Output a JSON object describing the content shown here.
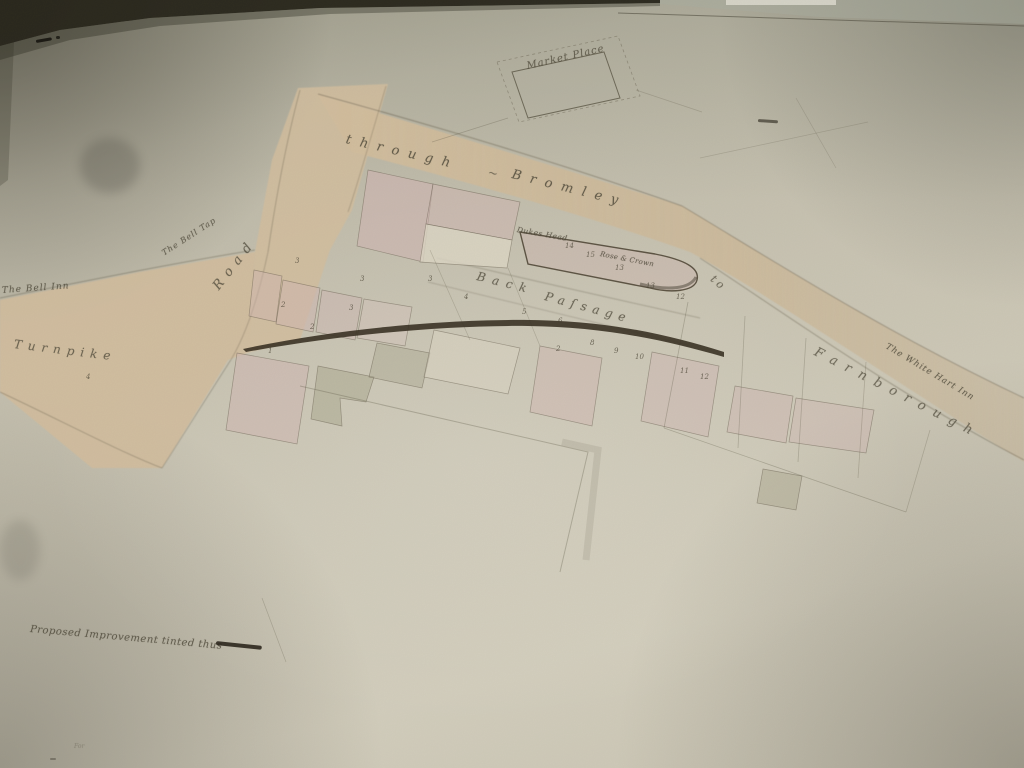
{
  "image_kind": "photograph of a hand-drawn 19th-century town improvement plan",
  "colors": {
    "paper": "#c8c3b2",
    "road_tint": "#d0bc9c",
    "building_pink": "#d0b5b2",
    "building_gray": "#aaa78e",
    "building_cream": "#dcd6c4",
    "ink": "#4c4738",
    "improvement_dark": "#352d20",
    "photo_background": "#262419"
  },
  "legend": {
    "text": "Proposed Improvement tinted thus",
    "swatch": "dark ink line"
  },
  "labels": [
    {
      "name": "market-place-label",
      "text": "Market Place",
      "x": 527,
      "y": 62,
      "rot": -13,
      "size": 10,
      "sp": 1,
      "op": 0.75
    },
    {
      "name": "road-name-through",
      "text": "through",
      "x": 346,
      "y": 133,
      "rot": 13,
      "size": 13,
      "sp": 9,
      "op": 0.8
    },
    {
      "name": "road-name-dash",
      "text": "~",
      "x": 488,
      "y": 166,
      "rot": 13,
      "size": 12,
      "sp": 0,
      "op": 0.65
    },
    {
      "name": "road-name-bromley",
      "text": "Bromley",
      "x": 512,
      "y": 168,
      "rot": 14,
      "size": 13,
      "sp": 9,
      "op": 0.8
    },
    {
      "name": "road-name-road",
      "text": "Road",
      "x": 216,
      "y": 282,
      "rot": -52,
      "size": 13,
      "sp": 7,
      "op": 0.75
    },
    {
      "name": "bell-tap-label",
      "text": "The Bell Tap",
      "x": 163,
      "y": 250,
      "rot": -33,
      "size": 8,
      "sp": 1,
      "op": 0.8
    },
    {
      "name": "bell-inn-label",
      "text": "The Bell Inn",
      "x": 2,
      "y": 287,
      "rot": -4,
      "size": 9,
      "sp": 1,
      "op": 0.8
    },
    {
      "name": "turnpike-label",
      "text": "Turnpike",
      "x": 14,
      "y": 338,
      "rot": 7,
      "size": 12,
      "sp": 6,
      "op": 0.75
    },
    {
      "name": "dukes-head-label",
      "text": "Dukes Head",
      "x": 517,
      "y": 226,
      "rot": 10,
      "size": 7.5,
      "sp": 0.5,
      "op": 0.8
    },
    {
      "name": "rose-and-crown-label",
      "text": "Rose & Crown",
      "x": 600,
      "y": 251,
      "rot": 11,
      "size": 7,
      "sp": 0.3,
      "op": 0.8
    },
    {
      "name": "back-passage-back",
      "text": "Back",
      "x": 477,
      "y": 270,
      "rot": 14,
      "size": 12,
      "sp": 7,
      "op": 0.75
    },
    {
      "name": "back-passage-passage",
      "text": "Paſsage",
      "x": 545,
      "y": 290,
      "rot": 15,
      "size": 12,
      "sp": 6,
      "op": 0.75
    },
    {
      "name": "road-name-to",
      "text": "to",
      "x": 712,
      "y": 272,
      "rot": 40,
      "size": 11,
      "sp": 3,
      "op": 0.7
    },
    {
      "name": "road-name-farnborough",
      "text": "Farnborough",
      "x": 815,
      "y": 345,
      "rot": 27,
      "size": 13,
      "sp": 9,
      "op": 0.7
    },
    {
      "name": "white-hart-inn-label",
      "text": "The White Hart Inn",
      "x": 886,
      "y": 342,
      "rot": 31,
      "size": 8.5,
      "sp": 1,
      "op": 0.8
    },
    {
      "name": "legend-text",
      "text": "Proposed Improvement tinted thus",
      "x": 30,
      "y": 625,
      "rot": 5,
      "size": 10,
      "sp": 0.5,
      "op": 0.8
    },
    {
      "name": "faint-note",
      "text": "For",
      "x": 74,
      "y": 744,
      "rot": 0,
      "size": 6,
      "sp": 0,
      "op": 0.3
    }
  ],
  "plot_numbers": [
    {
      "t": "3",
      "x": 295,
      "y": 258
    },
    {
      "t": "3",
      "x": 360,
      "y": 276
    },
    {
      "t": "3",
      "x": 428,
      "y": 276
    },
    {
      "t": "2",
      "x": 281,
      "y": 302
    },
    {
      "t": "3",
      "x": 349,
      "y": 305
    },
    {
      "t": "2",
      "x": 310,
      "y": 324
    },
    {
      "t": "1",
      "x": 268,
      "y": 348
    },
    {
      "t": "4",
      "x": 86,
      "y": 374
    },
    {
      "t": "4",
      "x": 464,
      "y": 294
    },
    {
      "t": "5",
      "x": 522,
      "y": 309
    },
    {
      "t": "6",
      "x": 558,
      "y": 318
    },
    {
      "t": "2",
      "x": 556,
      "y": 346
    },
    {
      "t": "8",
      "x": 590,
      "y": 340
    },
    {
      "t": "9",
      "x": 614,
      "y": 348
    },
    {
      "t": "10",
      "x": 635,
      "y": 354
    },
    {
      "t": "11",
      "x": 680,
      "y": 368
    },
    {
      "t": "12",
      "x": 700,
      "y": 374
    },
    {
      "t": "14",
      "x": 565,
      "y": 243
    },
    {
      "t": "15",
      "x": 586,
      "y": 252
    },
    {
      "t": "13",
      "x": 615,
      "y": 265
    },
    {
      "t": "13",
      "x": 646,
      "y": 283
    },
    {
      "t": "12",
      "x": 676,
      "y": 294
    }
  ],
  "marks": [
    {
      "type": "dash",
      "x": 36,
      "y": 40,
      "w": 16,
      "h": 3,
      "rot": -10,
      "c": "#17150f",
      "op": 0.9
    },
    {
      "type": "dash",
      "x": 56,
      "y": 36,
      "w": 4,
      "h": 3,
      "rot": 0,
      "c": "#17150f",
      "op": 0.8
    },
    {
      "type": "dash",
      "x": 758,
      "y": 119,
      "w": 20,
      "h": 2.5,
      "rot": 4,
      "c": "#3c382c",
      "op": 0.7
    },
    {
      "type": "swatch",
      "x": 216,
      "y": 641,
      "w": 46,
      "h": 4,
      "rot": 6,
      "c": "#241f15",
      "op": 0.85
    },
    {
      "type": "patch",
      "x": 80,
      "y": 138,
      "w": 60,
      "h": 55,
      "rot": 0,
      "c": "#32302a",
      "op": 0.2
    },
    {
      "type": "patch",
      "x": 0,
      "y": 520,
      "w": 40,
      "h": 60,
      "rot": 0,
      "c": "#32302a",
      "op": 0.12
    },
    {
      "type": "dash",
      "x": 50,
      "y": 758,
      "w": 6,
      "h": 2,
      "rot": 0,
      "c": "#3c382c",
      "op": 0.4
    }
  ]
}
